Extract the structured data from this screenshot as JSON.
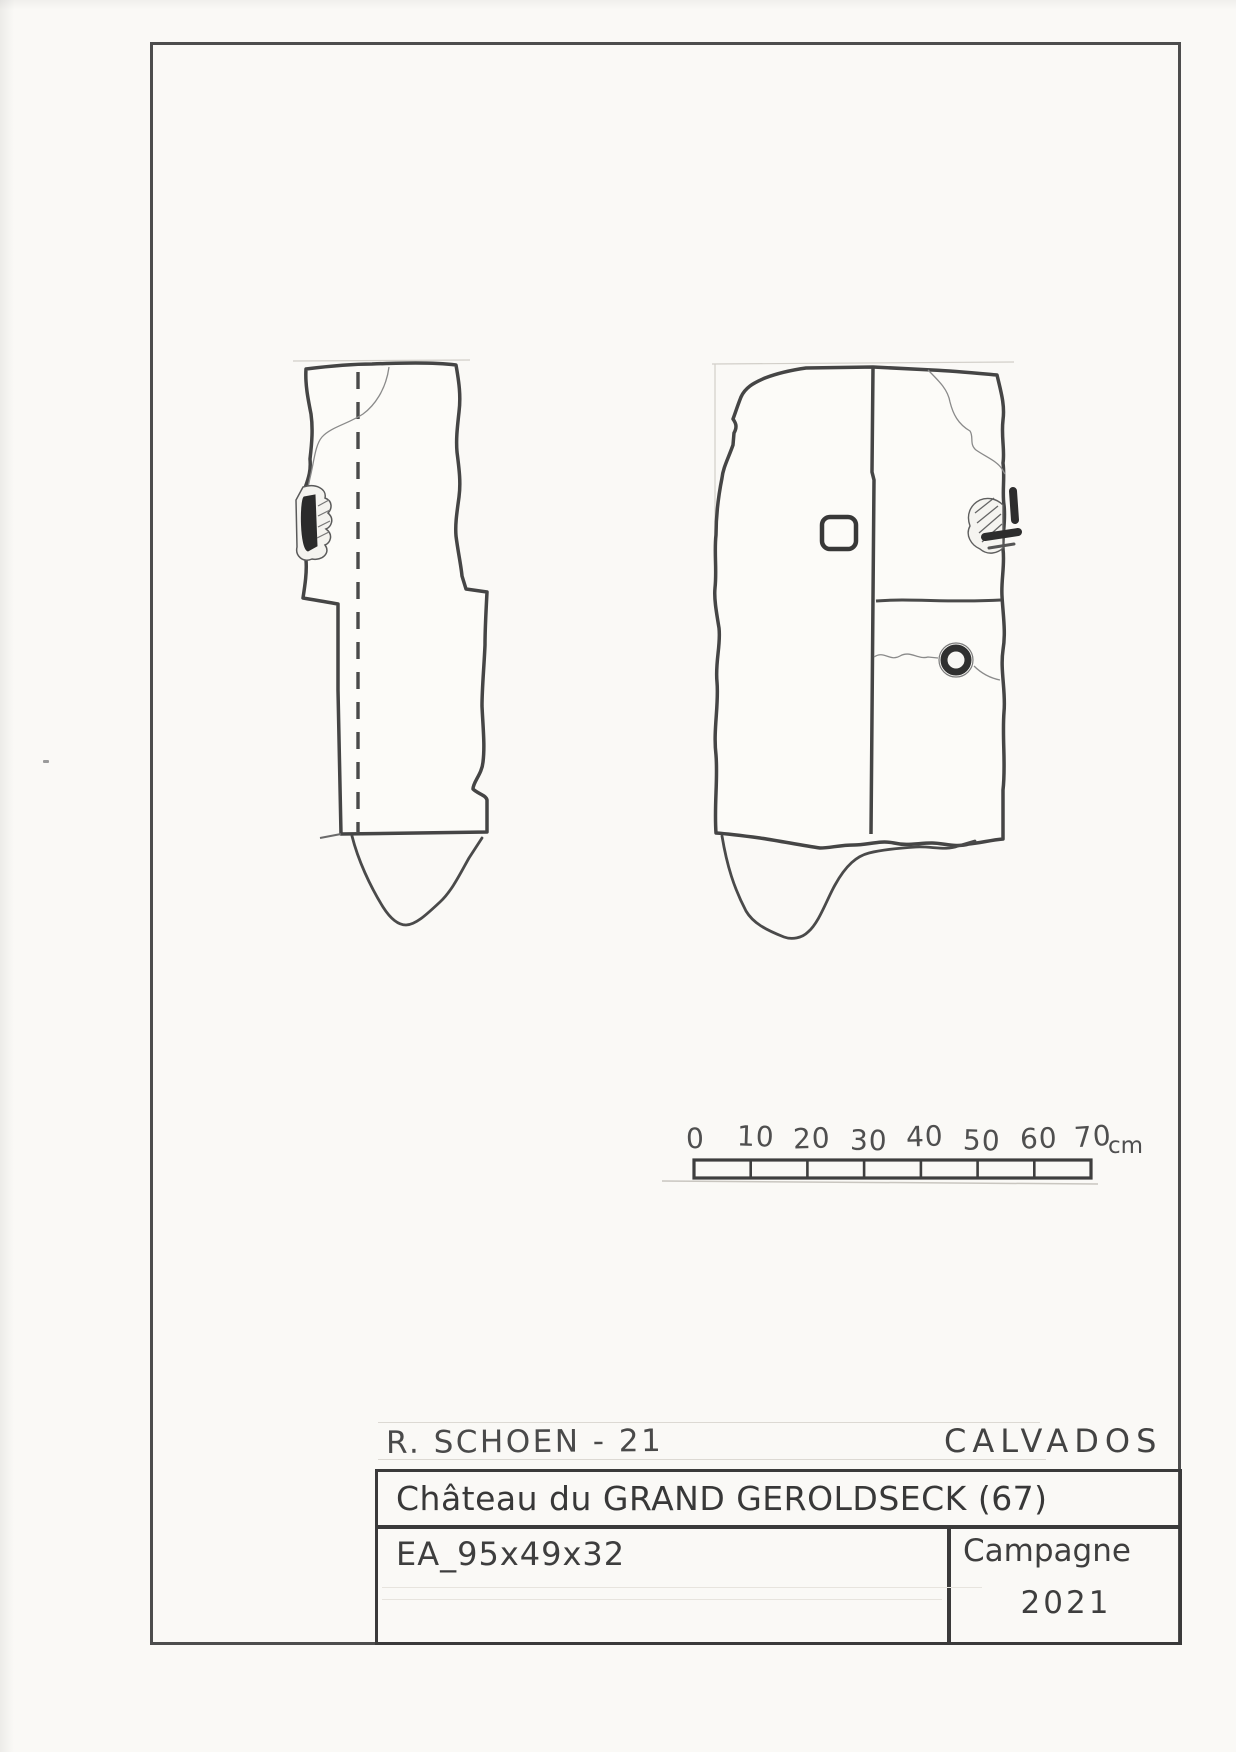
{
  "header": {
    "author_line": "R. SCHOEN - 21",
    "department": "CALVADOS"
  },
  "title_block": {
    "site_title": "Château du GRAND GEROLDSECK (67)",
    "artifact_ref": "EA_95x49x32",
    "campaign_label": "Campagne",
    "campaign_year": "2021"
  },
  "scale_bar": {
    "tick_labels": [
      "0",
      "10",
      "20",
      "30",
      "40",
      "50",
      "60",
      "70"
    ],
    "unit_label": "cm",
    "length_cm": 70
  },
  "colors": {
    "pencil_dark": "#454545",
    "pencil_light": "#8a8a8a",
    "paper": "#faf9f6"
  }
}
